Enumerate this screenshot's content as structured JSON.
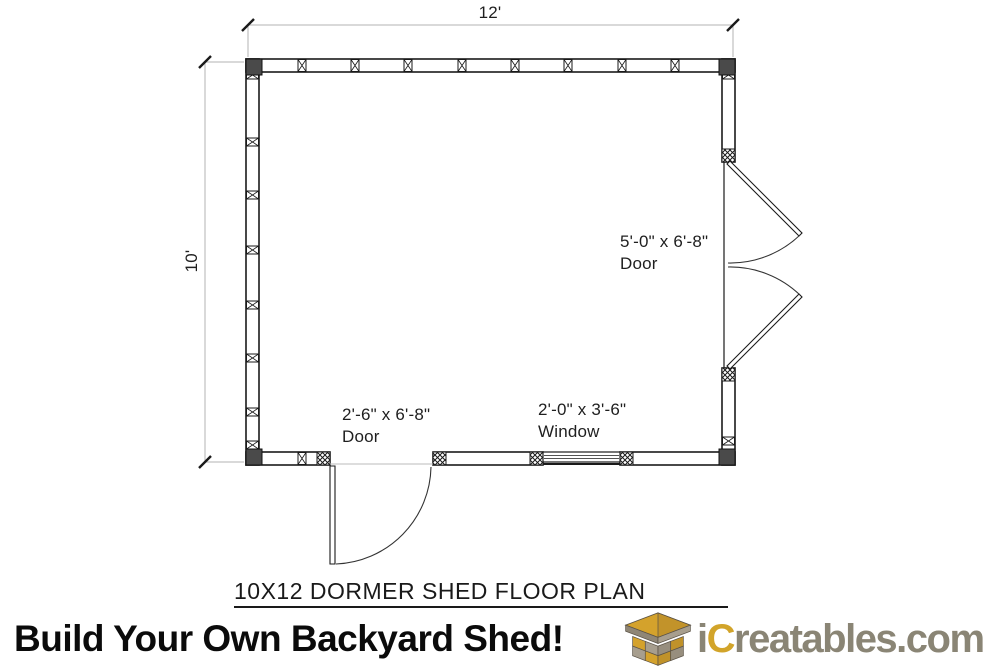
{
  "plan": {
    "title": "10X12 DORMER SHED FLOOR PLAN",
    "dim_width": "12'",
    "dim_depth": "10'",
    "labels": {
      "side_door": {
        "size": "5'-0\" x 6'-8\"",
        "type": "Door"
      },
      "front_door": {
        "size": "2'-6\" x 6'-8\"",
        "type": "Door"
      },
      "window": {
        "size": "2'-0\" x 3'-6\"",
        "type": "Window"
      }
    },
    "structure": {
      "width_ft": 12,
      "depth_ft": 10,
      "openings": [
        {
          "wall": "right",
          "kind": "double-door",
          "size": "5'-0\" x 6'-8\""
        },
        {
          "wall": "bottom",
          "kind": "single-door",
          "size": "2'-6\" x 6'-8\""
        },
        {
          "wall": "bottom",
          "kind": "window",
          "size": "2'-0\" x 3'-6\""
        }
      ]
    }
  },
  "footer": {
    "tagline": "Build Your Own Backyard Shed!",
    "brand_i": "i",
    "brand_c": "C",
    "brand_rest": "reatables.com",
    "logo_icon": "shed-logo-icon"
  },
  "colors": {
    "line": "#1a1a1a",
    "dim_line": "#b3b3b3",
    "corner_block": "#4a4a4a",
    "brand_gold": "#D2A42A",
    "brand_gray": "#8A8575",
    "logo_gold": "#D4A22C",
    "logo_gray": "#A79E8E"
  }
}
